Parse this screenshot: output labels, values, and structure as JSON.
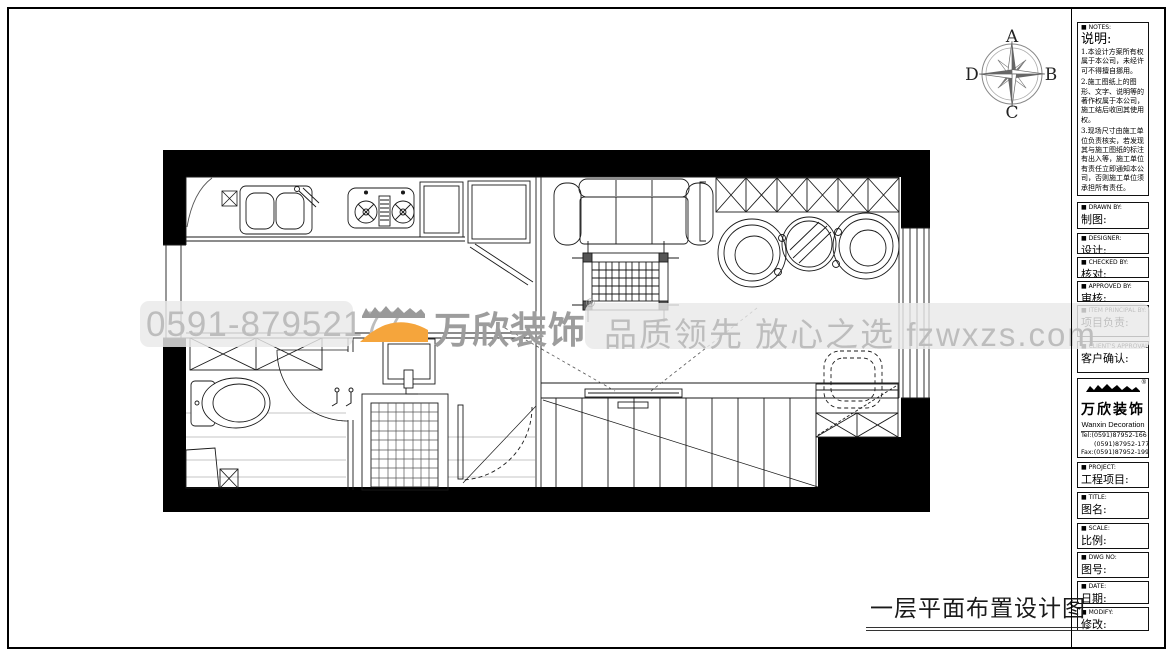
{
  "compass": {
    "north": "A",
    "east": "B",
    "south": "C",
    "west": "D"
  },
  "watermarks": {
    "phone": "0591-87952177",
    "brand": "万欣装饰",
    "brand_reg": "®",
    "slogan": "品质领先 放心之选 fzwxzs.com"
  },
  "drawing_title": "一层平面布置设计图",
  "title_block": {
    "notes": {
      "label_en": "■ NOTES:",
      "label_zh": "说明:",
      "items": [
        "1.本设计方案所有权属于本公司，未经许可不得擅自挪用。",
        "2.施工图纸上的图形、文字、说明等的著作权属于本公司，施工结后收回其使用权。",
        "3.现场尺寸由施工单位负责核实，若发现其与施工图纸的标注有出入等，施工单位有责任立即通知本公司，否则施工单位须承担所有责任。",
        "4.本设计方案是依客户要求设计，经客户签字即视为同意认可，不得随意更改。"
      ]
    },
    "fields": [
      {
        "en": "■ DRAWN BY:",
        "zh": "制图:"
      },
      {
        "en": "■ DESIGNER:",
        "zh": "设计:"
      },
      {
        "en": "■ CHECKED BY:",
        "zh": "核对:"
      },
      {
        "en": "■ APPROVED BY:",
        "zh": "审核:"
      },
      {
        "en": "■ ITEM PRINCIPAL BY:",
        "zh": "项目负责:"
      },
      {
        "en": "■ CLIENT'S APPROVAL:",
        "zh": "客户确认:"
      }
    ],
    "company": {
      "name": "万欣装饰",
      "name_en": "Wanxin Decoration",
      "reg": "®",
      "tel1": "Tel:(0591)87952-166",
      "tel2": "(0591)87952-177",
      "fax": "Fax:(0591)87952-199",
      "web": "Web:www.fzwxzs.com"
    },
    "fields_lower": [
      {
        "en": "■ PROJECT:",
        "zh": "工程项目:"
      },
      {
        "en": "■ TITLE:",
        "zh": "图名:"
      },
      {
        "en": "■ SCALE:",
        "zh": "比例:"
      },
      {
        "en": "■ DWG NO:",
        "zh": "图号:"
      },
      {
        "en": "■ DATE:",
        "zh": "日期:"
      },
      {
        "en": "■ MODIFY:",
        "zh": "修改:"
      }
    ]
  },
  "colors": {
    "wall": "#000000",
    "accent_orange": "#f5a53c",
    "watermark_text": "#bdbdbd",
    "band": "#ececec"
  }
}
